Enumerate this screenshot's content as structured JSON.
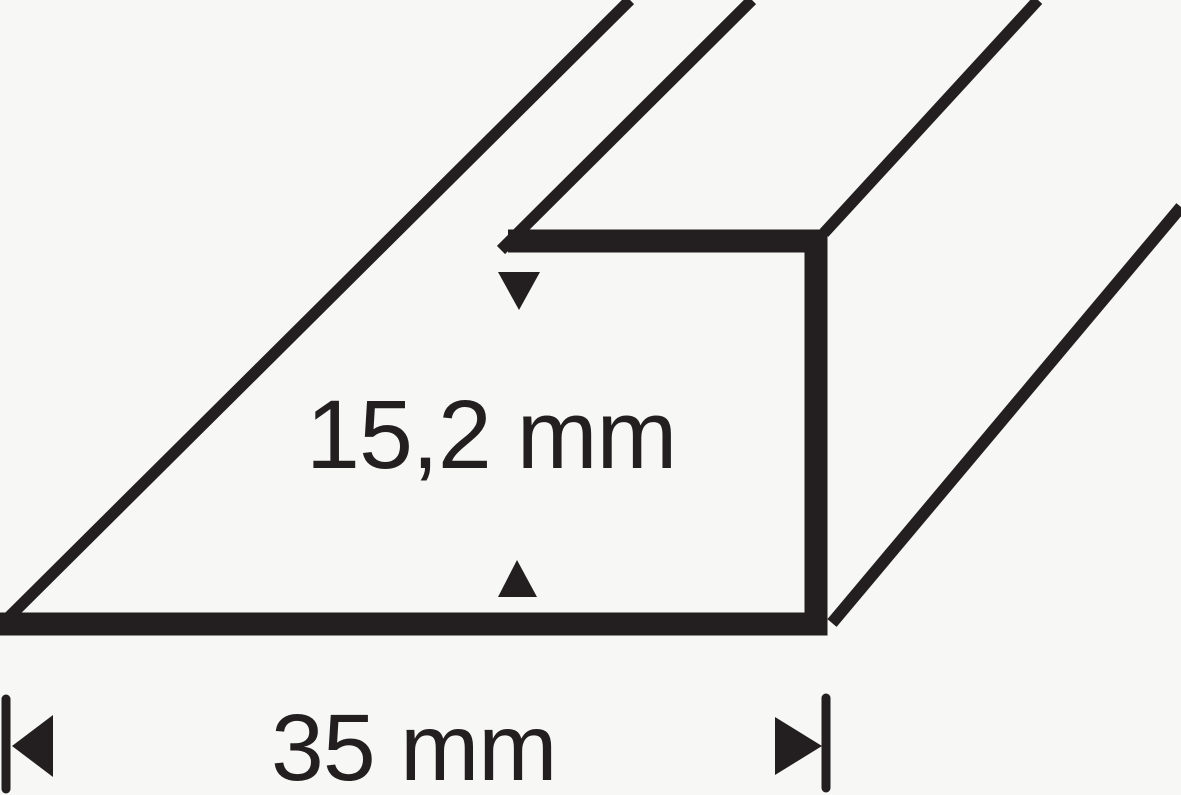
{
  "drawing": {
    "ink_color": "#231f20",
    "background_color": "#f7f7f5",
    "height_dimension": {
      "label": "15,2 mm",
      "value": "15,2",
      "unit": "mm"
    },
    "width_dimension": {
      "label": "35 mm",
      "value": "35",
      "unit": "mm"
    }
  }
}
